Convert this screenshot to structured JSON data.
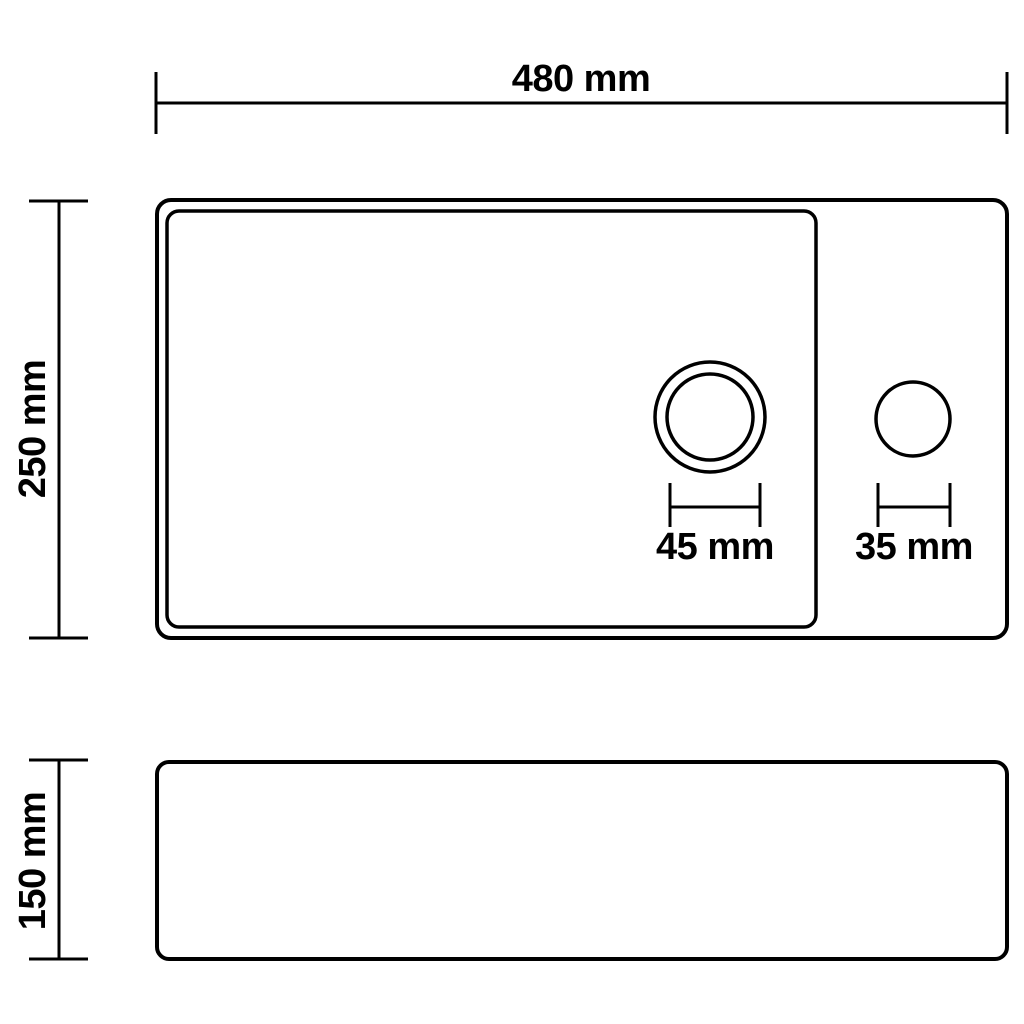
{
  "diagram": {
    "type": "technical-dimension-drawing",
    "subject": "rectangular basin with drain hole and faucet hole, top view and side view",
    "colors": {
      "line": "#000000",
      "background": "#ffffff"
    },
    "views": [
      {
        "id": "top-view",
        "description": "top view: outer rim, inner basin, drain hole, faucet hole"
      },
      {
        "id": "side-view",
        "description": "side view: outer profile"
      }
    ],
    "dimensions": {
      "overall_width": {
        "label": "480 mm",
        "value": 480,
        "unit": "mm"
      },
      "overall_depth": {
        "label": "250 mm",
        "value": 250,
        "unit": "mm"
      },
      "drain_hole_diameter": {
        "label": "45 mm",
        "value": 45,
        "unit": "mm"
      },
      "faucet_hole_diameter": {
        "label": "35 mm",
        "value": 35,
        "unit": "mm"
      },
      "overall_height": {
        "label": "150 mm",
        "value": 150,
        "unit": "mm"
      }
    }
  }
}
